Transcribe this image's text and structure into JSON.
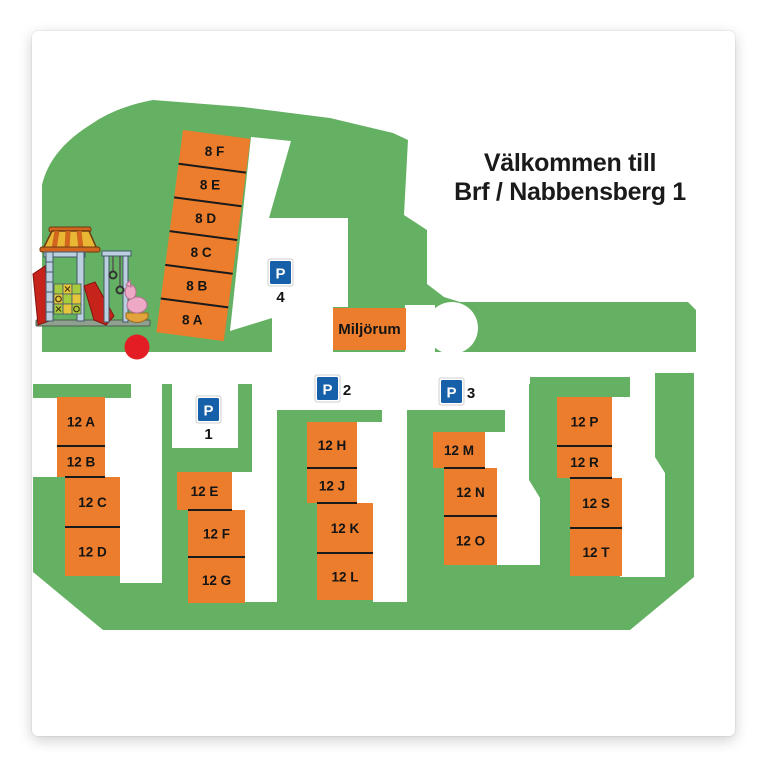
{
  "title": {
    "line1": "Välkommen till",
    "line2": "Brf / Nabbensberg 1"
  },
  "colors": {
    "green": "#65B163",
    "orange": "#EC7D2C",
    "blue": "#1660A9",
    "red": "#E41C23",
    "separator": "#1A1A1A",
    "label_text": "#141414"
  },
  "miljorum": {
    "label": "Miljörum"
  },
  "parking_signs": [
    {
      "id": "parking-sign-4",
      "letter": "P",
      "number": "4",
      "x": 270,
      "y": 261,
      "number_position": "below"
    },
    {
      "id": "parking-sign-1",
      "letter": "P",
      "number": "1",
      "x": 198,
      "y": 398,
      "number_position": "below"
    },
    {
      "id": "parking-sign-2",
      "letter": "P",
      "number": "2",
      "x": 317,
      "y": 377,
      "number_position": "right"
    },
    {
      "id": "parking-sign-3",
      "letter": "P",
      "number": "3",
      "x": 441,
      "y": 380,
      "number_position": "right"
    }
  ],
  "buildings_8": {
    "angle": 7.5,
    "pivot": [
      183,
      130
    ],
    "x": 183,
    "top": 130,
    "width": 68,
    "box_height": 34,
    "labels": [
      "8 F",
      "8 E",
      "8 D",
      "8 C",
      "8 B",
      "8 A"
    ]
  },
  "buildings_12": {
    "groups": [
      {
        "id": "group-12-a-d",
        "boxes": [
          {
            "label": "12 A",
            "x": 57,
            "y": 397,
            "w": 48,
            "h": 49
          },
          {
            "label": "12 B",
            "x": 57,
            "y": 446,
            "w": 48,
            "h": 31
          },
          {
            "label": "12 C",
            "x": 65,
            "y": 477,
            "w": 55,
            "h": 50
          },
          {
            "label": "12 D",
            "x": 65,
            "y": 527,
            "w": 55,
            "h": 49
          }
        ]
      },
      {
        "id": "group-12-e-g",
        "boxes": [
          {
            "label": "12 E",
            "x": 177,
            "y": 472,
            "w": 55,
            "h": 38
          },
          {
            "label": "12 F",
            "x": 188,
            "y": 510,
            "w": 57,
            "h": 47
          },
          {
            "label": "12 G",
            "x": 188,
            "y": 557,
            "w": 57,
            "h": 46
          }
        ]
      },
      {
        "id": "group-12-h-l",
        "boxes": [
          {
            "label": "12 H",
            "x": 307,
            "y": 422,
            "w": 50,
            "h": 46
          },
          {
            "label": "12 J",
            "x": 307,
            "y": 468,
            "w": 50,
            "h": 35
          },
          {
            "label": "12 K",
            "x": 317,
            "y": 503,
            "w": 56,
            "h": 50
          },
          {
            "label": "12 L",
            "x": 317,
            "y": 553,
            "w": 56,
            "h": 47
          }
        ]
      },
      {
        "id": "group-12-m-o",
        "boxes": [
          {
            "label": "12 M",
            "x": 433,
            "y": 432,
            "w": 52,
            "h": 36
          },
          {
            "label": "12 N",
            "x": 444,
            "y": 468,
            "w": 53,
            "h": 48
          },
          {
            "label": "12 O",
            "x": 444,
            "y": 516,
            "w": 53,
            "h": 49
          }
        ]
      },
      {
        "id": "group-12-p-t",
        "boxes": [
          {
            "label": "12 P",
            "x": 557,
            "y": 397,
            "w": 55,
            "h": 49
          },
          {
            "label": "12 R",
            "x": 557,
            "y": 446,
            "w": 55,
            "h": 32
          },
          {
            "label": "12 S",
            "x": 570,
            "y": 478,
            "w": 52,
            "h": 50
          },
          {
            "label": "12 T",
            "x": 570,
            "y": 528,
            "w": 52,
            "h": 48
          }
        ]
      }
    ]
  }
}
